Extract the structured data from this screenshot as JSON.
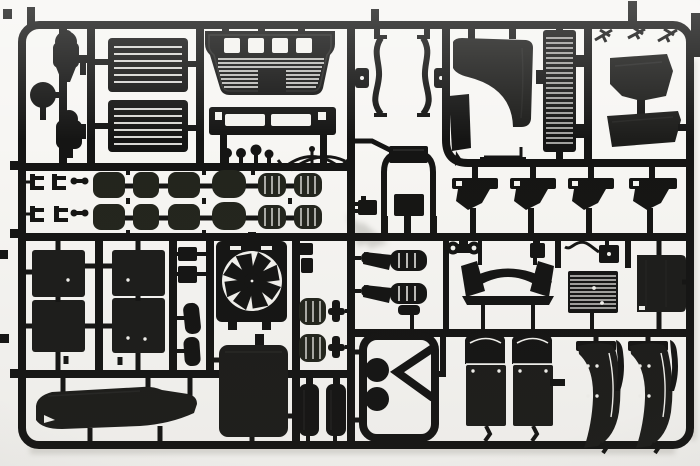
{
  "scene": {
    "title": "Photograph of an injection-moulded sprue of black styrene truck model-kit parts on a white background",
    "medium": "photograph",
    "subject": "plastic model kit runner (sprue) with truck parts",
    "plastic_finish": "black styrene",
    "backdrop": "plain white"
  },
  "colors": {
    "bg": "#f7f6f3",
    "detail": "#f4f3ef",
    "ink": "#151514",
    "ink2": "#1d1d1b",
    "olive": "#23251d",
    "line": "#2f2f2d",
    "mark": "#a9a9a3",
    "shade": "#8f8b82"
  },
  "parts": [
    {
      "id": "tank-canister-1",
      "label": "upright filter canister"
    },
    {
      "id": "round-disc",
      "label": "round cap / hub disc"
    },
    {
      "id": "tank-canister-2",
      "label": "upright filter canister"
    },
    {
      "id": "louver-panel-1",
      "label": "louvred hatch panel"
    },
    {
      "id": "louver-panel-2",
      "label": "louvred hatch panel"
    },
    {
      "id": "front-grille",
      "label": "front grille panel"
    },
    {
      "id": "lower-front-panel",
      "label": "lower front step panel"
    },
    {
      "id": "knob-set",
      "label": "control knobs"
    },
    {
      "id": "wiper-linkage",
      "label": "wiper linkage arms"
    },
    {
      "id": "a-pillar-trims",
      "label": "A-pillar trim strips"
    },
    {
      "id": "corner-deflector",
      "label": "cab corner air deflector"
    },
    {
      "id": "narrow-side-panel",
      "label": "narrow side trim panel"
    },
    {
      "id": "step-rail",
      "label": "step rail bracket"
    },
    {
      "id": "intake-stack",
      "label": "ribbed air-intake stack"
    },
    {
      "id": "wiper-arms",
      "label": "windscreen wiper arms"
    },
    {
      "id": "engine-cover",
      "label": "engine tunnel cover"
    },
    {
      "id": "visor-panel",
      "label": "sun visor panel"
    },
    {
      "id": "cab-steps",
      "label": "cab step brackets"
    },
    {
      "id": "cab-hoop",
      "label": "cab mounting hoop"
    },
    {
      "id": "junction-plate",
      "label": "junction plate"
    },
    {
      "id": "toothed-block",
      "label": "toothed connector block"
    },
    {
      "id": "hub-drums",
      "label": "brake drums and hubs"
    },
    {
      "id": "spring-clips",
      "label": "small spring clips"
    },
    {
      "id": "cab-panels",
      "label": "cab floor panels"
    },
    {
      "id": "mirrors",
      "label": "mirror glasses and housings"
    },
    {
      "id": "fan-shroud",
      "label": "radiator fan with shroud"
    },
    {
      "id": "radiator-panel",
      "label": "radiator / intercooler panel"
    },
    {
      "id": "air-tanks-horizontal",
      "label": "horizontal air tanks"
    },
    {
      "id": "t-fittings",
      "label": "pipe T-fittings"
    },
    {
      "id": "air-reservoirs",
      "label": "vertical air reservoirs"
    },
    {
      "id": "air-springs",
      "label": "air-spring lever units"
    },
    {
      "id": "tow-shackle",
      "label": "towing shackle"
    },
    {
      "id": "valve-block",
      "label": "valve block"
    },
    {
      "id": "cable-box",
      "label": "junction box with cable"
    },
    {
      "id": "roof-light-bar",
      "label": "roof light bar with end plates"
    },
    {
      "id": "ribbed-core",
      "label": "ribbed heat-exchanger core"
    },
    {
      "id": "side-skirt",
      "label": "side skirt panel"
    },
    {
      "id": "chassis-bracket",
      "label": "chassis cross-member with twin horns"
    },
    {
      "id": "roof-bumper",
      "label": "cab roof / bumper fascia"
    },
    {
      "id": "mudguards",
      "label": "mudguards with mud flaps"
    },
    {
      "id": "quarter-fenders",
      "label": "quarter fenders"
    },
    {
      "id": "fender-strips",
      "label": "fender edge strips"
    }
  ]
}
